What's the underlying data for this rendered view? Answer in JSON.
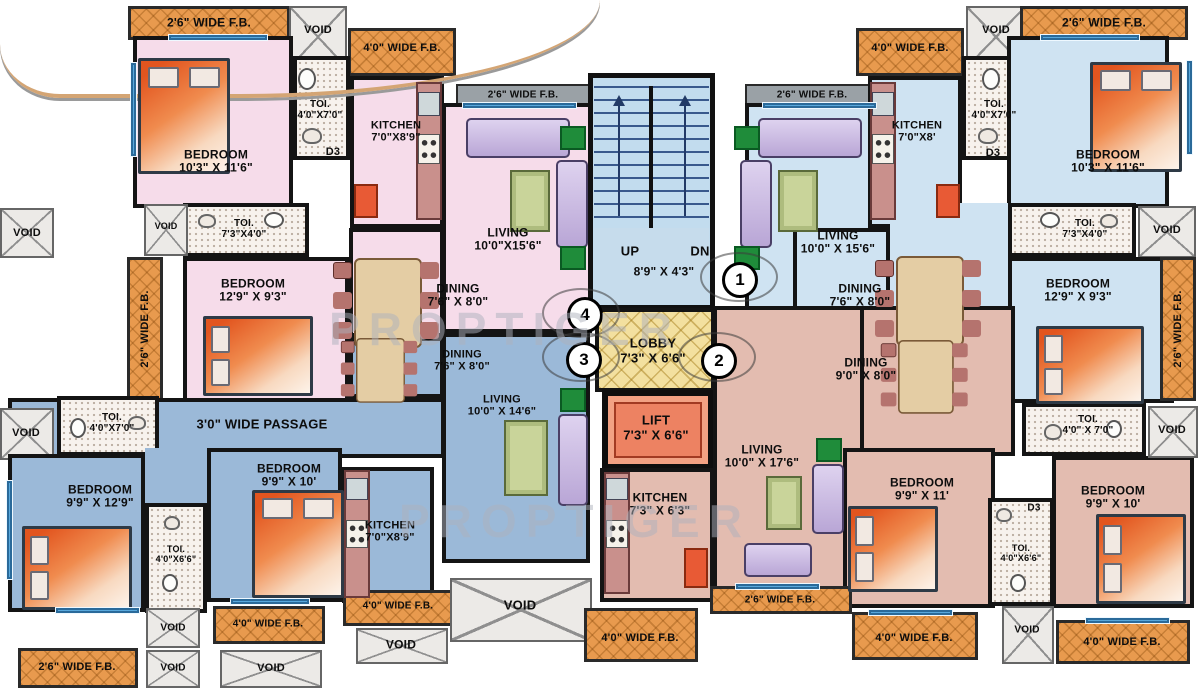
{
  "plan": {
    "watermark_text": "PROPTIGER",
    "labels": [
      {
        "name": "fb-label-top-left",
        "text": "2'6\" WIDE F.B.",
        "x": 209,
        "y": 23,
        "fs": 12
      },
      {
        "name": "void-label-top-left",
        "text": "VOID",
        "x": 318,
        "y": 30,
        "fs": 11
      },
      {
        "name": "fb-label-40-top-left",
        "text": "4'0\" WIDE F.B.",
        "x": 402,
        "y": 48,
        "fs": 11
      },
      {
        "name": "bedroom-label-f4-1",
        "text": "BEDROOM\n10'3\" X 11'6\"",
        "x": 216,
        "y": 162,
        "fs": 12
      },
      {
        "name": "toi-label-f4-1",
        "text": "TOI.\n4'0\"X7'0\"",
        "x": 320,
        "y": 110,
        "fs": 10
      },
      {
        "name": "door-label-f4-d3",
        "text": "D3",
        "x": 333,
        "y": 152,
        "fs": 11
      },
      {
        "name": "kitchen-label-f4",
        "text": "KITCHEN\n7'0\"X8'9\"",
        "x": 396,
        "y": 132,
        "fs": 11
      },
      {
        "name": "fb-label-gray-f4",
        "text": "2'6\" WIDE F.B.",
        "x": 523,
        "y": 95,
        "fs": 10
      },
      {
        "name": "living-label-f4",
        "text": "LIVING\n10'0\"X15'6\"",
        "x": 508,
        "y": 240,
        "fs": 12
      },
      {
        "name": "void-label-left-f4",
        "text": "VOID",
        "x": 27,
        "y": 233,
        "fs": 11
      },
      {
        "name": "void-label-small-f4",
        "text": "VOID",
        "x": 166,
        "y": 226,
        "fs": 9
      },
      {
        "name": "toi-label-f4-2",
        "text": "TOI.\n7'3\"X4'0\"",
        "x": 244,
        "y": 229,
        "fs": 10
      },
      {
        "name": "bedroom-label-f4-2",
        "text": "BEDROOM\n12'9\" X 9'3\"",
        "x": 253,
        "y": 291,
        "fs": 12
      },
      {
        "name": "dining-label-f4",
        "text": "DINING\n7'6\" X 8'0\"",
        "x": 458,
        "y": 296,
        "fs": 12
      },
      {
        "name": "fb-label-vert-left",
        "text": "2'6\" WIDE F.B.",
        "x": 145,
        "y": 329,
        "fs": 11,
        "rot": -90
      },
      {
        "name": "fb-label-gray-f1",
        "text": "2'6\" WIDE F.B.",
        "x": 812,
        "y": 95,
        "fs": 10
      },
      {
        "name": "fb-label-40-top-right",
        "text": "4'0\" WIDE F.B.",
        "x": 910,
        "y": 48,
        "fs": 11
      },
      {
        "name": "void-label-top-right",
        "text": "VOID",
        "x": 996,
        "y": 30,
        "fs": 11
      },
      {
        "name": "fb-label-top-right",
        "text": "2'6\" WIDE F.B.",
        "x": 1104,
        "y": 23,
        "fs": 12
      },
      {
        "name": "living-label-f1",
        "text": "LIVING\n10'0\" X 15'6\"",
        "x": 838,
        "y": 243,
        "fs": 12
      },
      {
        "name": "kitchen-label-f1",
        "text": "KITCHEN\n7'0\"X8'",
        "x": 917,
        "y": 132,
        "fs": 11
      },
      {
        "name": "toi-label-f1-1",
        "text": "TOI.\n4'0\"X7'0\"",
        "x": 994,
        "y": 110,
        "fs": 10
      },
      {
        "name": "door-label-f1-d3",
        "text": "D3",
        "x": 993,
        "y": 153,
        "fs": 11
      },
      {
        "name": "bedroom-label-f1-1",
        "text": "BEDROOM\n10'3\" X 11'6\"",
        "x": 1108,
        "y": 162,
        "fs": 12
      },
      {
        "name": "toi-label-f1-2",
        "text": "TOI.\n7'3\"X4'0\"",
        "x": 1085,
        "y": 229,
        "fs": 10
      },
      {
        "name": "void-label-right-f1",
        "text": "VOID",
        "x": 1167,
        "y": 230,
        "fs": 11
      },
      {
        "name": "bedroom-label-f1-2",
        "text": "BEDROOM\n12'9\" X 9'3\"",
        "x": 1078,
        "y": 291,
        "fs": 12
      },
      {
        "name": "dining-label-f1",
        "text": "DINING\n7'6\" X 8'0\"",
        "x": 860,
        "y": 296,
        "fs": 12
      },
      {
        "name": "fb-label-vert-right",
        "text": "2'6\" WIDE F.B.",
        "x": 1178,
        "y": 329,
        "fs": 11,
        "rot": -90
      },
      {
        "name": "stair-up-label",
        "text": "UP",
        "x": 630,
        "y": 252,
        "fs": 13
      },
      {
        "name": "stair-dn-label",
        "text": "DN",
        "x": 700,
        "y": 252,
        "fs": 13
      },
      {
        "name": "stair-dim-label",
        "text": "8'9\" X 4'3\"",
        "x": 664,
        "y": 272,
        "fs": 12
      },
      {
        "name": "lobby-label",
        "text": "LOBBY\n7'3\" X 6'6\"",
        "x": 653,
        "y": 351,
        "fs": 13
      },
      {
        "name": "lift-label",
        "text": "LIFT\n7'3\" X 6'6\"",
        "x": 656,
        "y": 428,
        "fs": 13
      },
      {
        "name": "kitchen-label-f2",
        "text": "KITCHEN\n7'3\" X 6'3\"",
        "x": 660,
        "y": 505,
        "fs": 12
      },
      {
        "name": "dining-label-f3",
        "text": "DINING\n7'6\" X 8'0\"",
        "x": 462,
        "y": 361,
        "fs": 11
      },
      {
        "name": "living-label-f3",
        "text": "LIVING\n10'0\" X 14'6\"",
        "x": 502,
        "y": 406,
        "fs": 11
      },
      {
        "name": "passage-label-f3",
        "text": "3'0\" WIDE PASSAGE",
        "x": 262,
        "y": 425,
        "fs": 13
      },
      {
        "name": "void-label-left-f3",
        "text": "VOID",
        "x": 26,
        "y": 433,
        "fs": 11
      },
      {
        "name": "toi-label-f3-1",
        "text": "TOI.\n4'0\"X7'0\"",
        "x": 112,
        "y": 423,
        "fs": 10
      },
      {
        "name": "bedroom-label-f3-1",
        "text": "BEDROOM\n9'9\" X 12'9\"",
        "x": 100,
        "y": 497,
        "fs": 12
      },
      {
        "name": "bedroom-label-f3-2",
        "text": "BEDROOM\n9'9\" X 10'",
        "x": 289,
        "y": 476,
        "fs": 12
      },
      {
        "name": "toi-label-f3-2",
        "text": "TOI.\n4'0\"X6'6\"",
        "x": 176,
        "y": 554,
        "fs": 9
      },
      {
        "name": "kitchen-label-f3",
        "text": "KITCHEN\n7'0\"X8'9\"",
        "x": 390,
        "y": 532,
        "fs": 11
      },
      {
        "name": "fb-label-26-bottom-left",
        "text": "2'6\" WIDE F.B.",
        "x": 77,
        "y": 667,
        "fs": 11
      },
      {
        "name": "void-label-bl-1",
        "text": "VOID",
        "x": 173,
        "y": 628,
        "fs": 10
      },
      {
        "name": "void-label-bl-2",
        "text": "VOID",
        "x": 173,
        "y": 668,
        "fs": 10
      },
      {
        "name": "void-label-bl-3",
        "text": "VOID",
        "x": 271,
        "y": 668,
        "fs": 11
      },
      {
        "name": "fb-label-40-bl-1",
        "text": "4'0\" WIDE F.B.",
        "x": 268,
        "y": 624,
        "fs": 10
      },
      {
        "name": "fb-label-40-bl-2",
        "text": "4'0\" WIDE F.B.",
        "x": 398,
        "y": 606,
        "fs": 10
      },
      {
        "name": "void-label-big",
        "text": "VOID",
        "x": 520,
        "y": 606,
        "fs": 13
      },
      {
        "name": "void-label-bl-4",
        "text": "VOID",
        "x": 401,
        "y": 645,
        "fs": 12
      },
      {
        "name": "dining-label-f2",
        "text": "DINING\n9'0\" X 8'0\"",
        "x": 866,
        "y": 370,
        "fs": 12
      },
      {
        "name": "living-label-f2",
        "text": "LIVING\n10'0\" X 17'6\"",
        "x": 762,
        "y": 457,
        "fs": 12
      },
      {
        "name": "bedroom-label-f2-1",
        "text": "BEDROOM\n9'9\" X 11'",
        "x": 922,
        "y": 490,
        "fs": 12
      },
      {
        "name": "bedroom-label-f2-2",
        "text": "BEDROOM\n9'9\" X 10'",
        "x": 1113,
        "y": 498,
        "fs": 12
      },
      {
        "name": "toi-label-f2-top",
        "text": "TOI.\n4'0\" X 7'0\"",
        "x": 1088,
        "y": 425,
        "fs": 10
      },
      {
        "name": "void-label-right-f2",
        "text": "VOID",
        "x": 1172,
        "y": 430,
        "fs": 11
      },
      {
        "name": "door-label-f2-d3",
        "text": "D3",
        "x": 1034,
        "y": 508,
        "fs": 10
      },
      {
        "name": "toi-label-f2-mid",
        "text": "TOI.\n4'0\"X6'6\"",
        "x": 1021,
        "y": 553,
        "fs": 9
      },
      {
        "name": "fb-label-26-bottom-right",
        "text": "2'6\" WIDE F.B.",
        "x": 780,
        "y": 600,
        "fs": 10
      },
      {
        "name": "fb-label-40-bc",
        "text": "4'0\" WIDE F.B.",
        "x": 640,
        "y": 638,
        "fs": 11
      },
      {
        "name": "fb-label-40-br-1",
        "text": "4'0\" WIDE F.B.",
        "x": 914,
        "y": 638,
        "fs": 11
      },
      {
        "name": "void-label-br",
        "text": "VOID",
        "x": 1027,
        "y": 630,
        "fs": 10
      },
      {
        "name": "fb-label-40-br-2",
        "text": "4'0\" WIDE F.B.",
        "x": 1122,
        "y": 642,
        "fs": 11
      },
      {
        "name": "watermark-1",
        "text": "PROPTIGER",
        "x": 505,
        "y": 330,
        "fs": 46,
        "cls": "wm"
      },
      {
        "name": "watermark-2",
        "text": "PROPTIGER",
        "x": 575,
        "y": 522,
        "fs": 46,
        "cls": "wm"
      }
    ],
    "circles": [
      {
        "name": "flat-number-1",
        "text": "1",
        "x": 737,
        "y": 277
      },
      {
        "name": "flat-number-2",
        "text": "2",
        "x": 716,
        "y": 358
      },
      {
        "name": "flat-number-3",
        "text": "3",
        "x": 581,
        "y": 357
      },
      {
        "name": "flat-number-4",
        "text": "4",
        "x": 582,
        "y": 312
      }
    ]
  }
}
